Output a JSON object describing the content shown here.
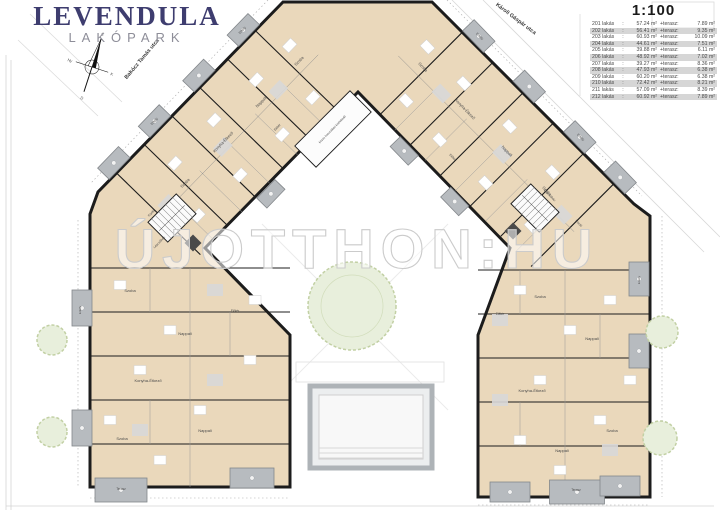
{
  "logo": {
    "name": "LEVENDULA",
    "subtitle": "LAKÓPARK",
    "color": "#3e3d6f",
    "subtitle_color": "#8e8e99"
  },
  "scale_label": "1:100",
  "streets": [
    {
      "name": "Bakócz Tamás utca"
    },
    {
      "name": "Károli Gáspár utca"
    }
  ],
  "compass": {
    "points": [
      "É",
      "K",
      "D",
      "Ny"
    ]
  },
  "watermark": {
    "text": "ÚJOTTHON:HU"
  },
  "units_table": {
    "separator": ":",
    "terrace_label": "+terasz:",
    "rows": [
      {
        "unit": "201 lakás",
        "area": "57.24 m²",
        "terrace": "7.89 m²"
      },
      {
        "unit": "202 lakás",
        "area": "56.41 m²",
        "terrace": "9.35 m²"
      },
      {
        "unit": "203 lakás",
        "area": "60.93 m²",
        "terrace": "10.09 m²"
      },
      {
        "unit": "204 lakás",
        "area": "44.61 m²",
        "terrace": "7.51 m²"
      },
      {
        "unit": "205 lakás",
        "area": "39.88 m²",
        "terrace": "6.11 m²"
      },
      {
        "unit": "206 lakás",
        "area": "48.92 m²",
        "terrace": "7.02 m²"
      },
      {
        "unit": "207 lakás",
        "area": "39.27 m²",
        "terrace": "8.36 m²"
      },
      {
        "unit": "208 lakás",
        "area": "47.93 m²",
        "terrace": "6.38 m²"
      },
      {
        "unit": "209 lakás",
        "area": "60.20 m²",
        "terrace": "6.38 m²"
      },
      {
        "unit": "210 lakás",
        "area": "72.42 m²",
        "terrace": "8.21 m²"
      },
      {
        "unit": "211 lakás",
        "area": "57.09 m²",
        "terrace": "8.39 m²"
      },
      {
        "unit": "212 lakás",
        "area": "60.92 m²",
        "terrace": "7.89 m²"
      }
    ]
  },
  "plan": {
    "colors": {
      "room_fill": "#ead8bb",
      "balcony_fill": "#b7bbbf",
      "balcony_stroke": "#83878b",
      "wall": "#1c1c1c",
      "tree_fill": "#e8efdc",
      "tree_stroke": "#c2d0a4",
      "label": "#4a4a4a",
      "site_line": "#d4d4d4"
    },
    "room_labels": [
      {
        "t": "Szoba",
        "x": 300,
        "y": 62,
        "r": -46
      },
      {
        "t": "Nappali",
        "x": 262,
        "y": 103,
        "r": -46
      },
      {
        "t": "Konyha-Étkező",
        "x": 224,
        "y": 143,
        "r": -46
      },
      {
        "t": "Előtér",
        "x": 278,
        "y": 128,
        "r": -46,
        "fs": 3.2
      },
      {
        "t": "Szoba",
        "x": 186,
        "y": 184,
        "r": -46
      },
      {
        "t": "Fürdő",
        "x": 152,
        "y": 214,
        "r": -46,
        "fs": 3.2
      },
      {
        "t": "Lépcsőház",
        "x": 160,
        "y": 243,
        "r": -46,
        "fs": 3.2
      },
      {
        "t": "Szoba",
        "x": 422,
        "y": 68,
        "r": 46
      },
      {
        "t": "Konyha-Étkező",
        "x": 464,
        "y": 110,
        "r": 46
      },
      {
        "t": "Előtér",
        "x": 452,
        "y": 158,
        "r": 46,
        "fs": 3.2
      },
      {
        "t": "Nappali",
        "x": 506,
        "y": 152,
        "r": 46
      },
      {
        "t": "Szoba",
        "x": 546,
        "y": 192,
        "r": 46
      },
      {
        "t": "Fürdő",
        "x": 578,
        "y": 224,
        "r": 46,
        "fs": 3.2
      },
      {
        "t": "Lépcsőház",
        "x": 549,
        "y": 196,
        "r": 46,
        "fs": 3.2
      },
      {
        "t": "közös használatú közlekedő",
        "x": 333,
        "y": 130,
        "r": -46,
        "fs": 3
      },
      {
        "t": "Szoba",
        "x": 130,
        "y": 292,
        "r": 0
      },
      {
        "t": "Nappali",
        "x": 185,
        "y": 335,
        "r": 0
      },
      {
        "t": "Előtér",
        "x": 235,
        "y": 312,
        "r": 0,
        "fs": 3.2
      },
      {
        "t": "Konyha-Étkező",
        "x": 148,
        "y": 382,
        "r": 0
      },
      {
        "t": "Szoba",
        "x": 122,
        "y": 440,
        "r": 0
      },
      {
        "t": "Nappali",
        "x": 205,
        "y": 432,
        "r": 0
      },
      {
        "t": "Terasz",
        "x": 121,
        "y": 490,
        "r": 0,
        "fs": 3.2
      },
      {
        "t": "Szoba",
        "x": 540,
        "y": 298,
        "r": 0
      },
      {
        "t": "Nappali",
        "x": 592,
        "y": 340,
        "r": 0
      },
      {
        "t": "Előtér",
        "x": 500,
        "y": 315,
        "r": 0,
        "fs": 3.2
      },
      {
        "t": "Konyha-Étkező",
        "x": 532,
        "y": 392,
        "r": 0
      },
      {
        "t": "Szoba",
        "x": 612,
        "y": 432,
        "r": 0
      },
      {
        "t": "Nappali",
        "x": 562,
        "y": 452,
        "r": 0
      },
      {
        "t": "Terasz",
        "x": 576,
        "y": 491,
        "r": 0,
        "fs": 3.2
      },
      {
        "t": "Erkély",
        "x": 243,
        "y": 31,
        "r": -46,
        "fs": 3.2
      },
      {
        "t": "Erkély",
        "x": 155,
        "y": 122,
        "r": -46,
        "fs": 3.2
      },
      {
        "t": "Erkély",
        "x": 479,
        "y": 37,
        "r": 46,
        "fs": 3.2
      },
      {
        "t": "Erkély",
        "x": 580,
        "y": 138,
        "r": 46,
        "fs": 3.2
      },
      {
        "t": "Erkély",
        "x": 81,
        "y": 310,
        "r": -90,
        "fs": 3
      },
      {
        "t": "Erkély",
        "x": 640,
        "y": 280,
        "r": -90,
        "fs": 3
      }
    ]
  }
}
